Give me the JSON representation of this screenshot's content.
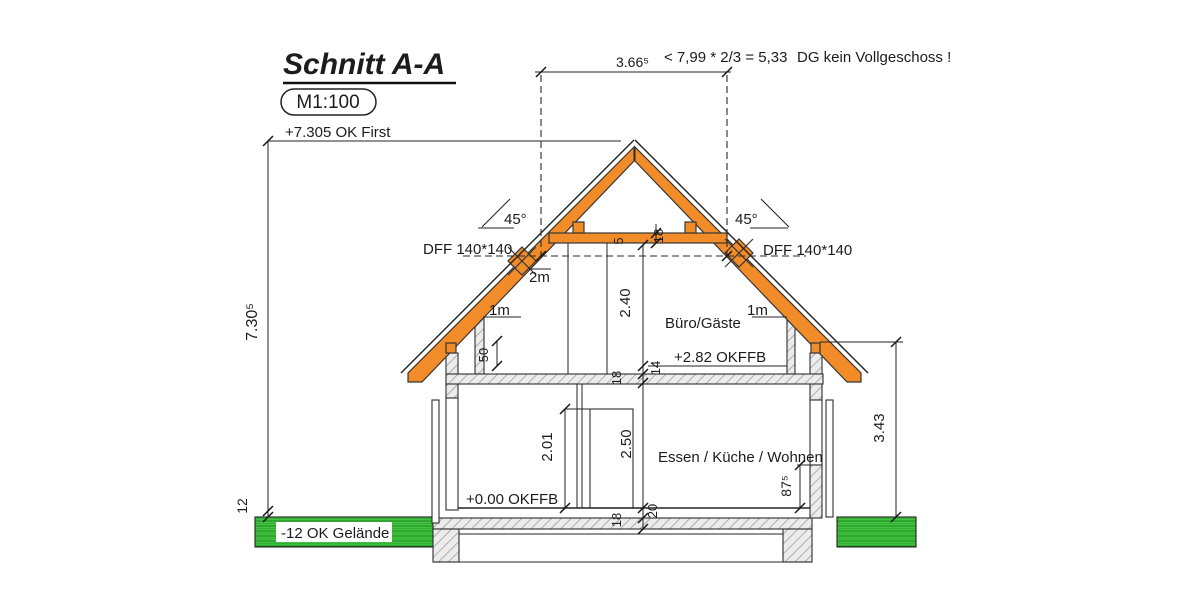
{
  "labels": {
    "title": "Schnitt A-A",
    "scale": "M1:100",
    "ridge": "+7.305 OK First",
    "dim_top_width": "3.66⁵",
    "formula": "< 7,99 * 2/3 = 5,33",
    "note_dg": "DG kein Vollgeschoss !",
    "angle_l": "45°",
    "angle_r": "45°",
    "dff_l": "DFF 140*140",
    "dff_r": "DFF 140*140",
    "h2m": "2m",
    "h1m_l": "1m",
    "h1m_r": "1m",
    "dim_attic_height": "2.40",
    "room_attic": "Büro/Gäste",
    "level_attic": "+2.82 OKFFB",
    "dim_knee": "50",
    "dim_gap5": "5",
    "dim_collar18": "18",
    "dim_attic_screed": "14",
    "dim_attic_slab": "18",
    "dim_total_height": "7.30⁵",
    "dim_terrain": "12",
    "dim_door": "2.01",
    "dim_ground_height": "2.50",
    "room_ground": "Essen / Küche / Wohnen",
    "level_ground": "+0.00 OKFFB",
    "dim_parapet": "87⁵",
    "dim_eaves": "3.43",
    "level_terrain": "-12 OK Gelände",
    "dim_ground_screed": "20",
    "dim_ground_slab": "18"
  },
  "colors": {
    "roof": "#F28C28",
    "ground_fill": "#41C341",
    "line": "#232323",
    "hatch_bg": "#ECECEC",
    "hatch_line": "#9F9F9F"
  }
}
